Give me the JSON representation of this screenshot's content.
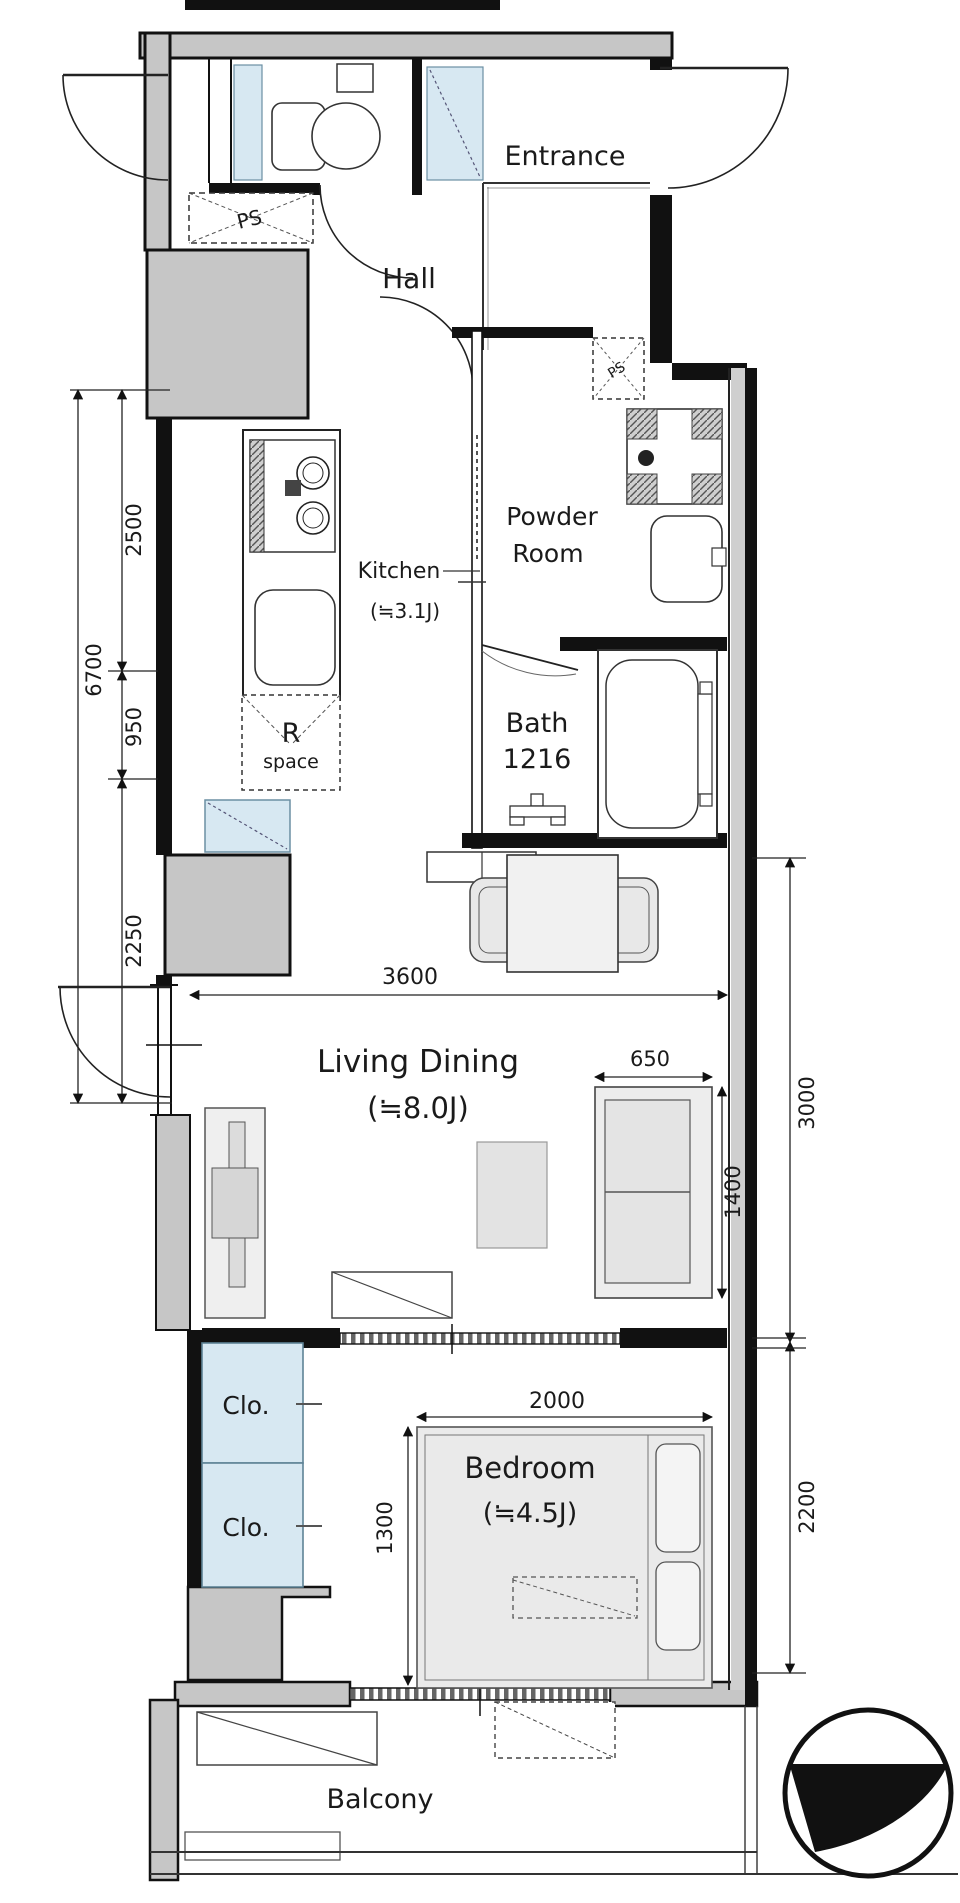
{
  "plan_title": "apartment-floor-plan",
  "rooms": {
    "entrance": {
      "label": "Entrance"
    },
    "hall": {
      "label": "Hall"
    },
    "powder": {
      "line1": "Powder",
      "line2": "Room"
    },
    "kitchen": {
      "line1": "Kitchen",
      "line2": "(≒3.1J)"
    },
    "bath": {
      "line1": "Bath",
      "line2": "1216"
    },
    "r_space": {
      "line1": "R",
      "line2": "space"
    },
    "living": {
      "line1": "Living Dining",
      "line2": "(≒8.0J)"
    },
    "bedroom": {
      "line1": "Bedroom",
      "line2": "(≒4.5J)"
    },
    "closet_upper": {
      "label": "Clo."
    },
    "closet_lower": {
      "label": "Clo."
    },
    "balcony": {
      "label": "Balcony"
    },
    "ps_hall": {
      "label": "PS"
    },
    "ps_powder": {
      "label": "PS"
    }
  },
  "dims": {
    "d2500": "2500",
    "d6700": "6700",
    "d950": "950",
    "d2250": "2250",
    "d3600": "3600",
    "d650": "650",
    "d1400": "1400",
    "d3000": "3000",
    "d2000": "2000",
    "d1300": "1300",
    "d2200": "2200"
  },
  "colors": {
    "wall_fill": "#c6c6c6",
    "wall_line": "#111111",
    "accent_blue": "#d7e8f2",
    "exterior_shade": "#cfcfcf",
    "furniture_fill": "#ebebeb",
    "text": "#1a1a1a"
  }
}
